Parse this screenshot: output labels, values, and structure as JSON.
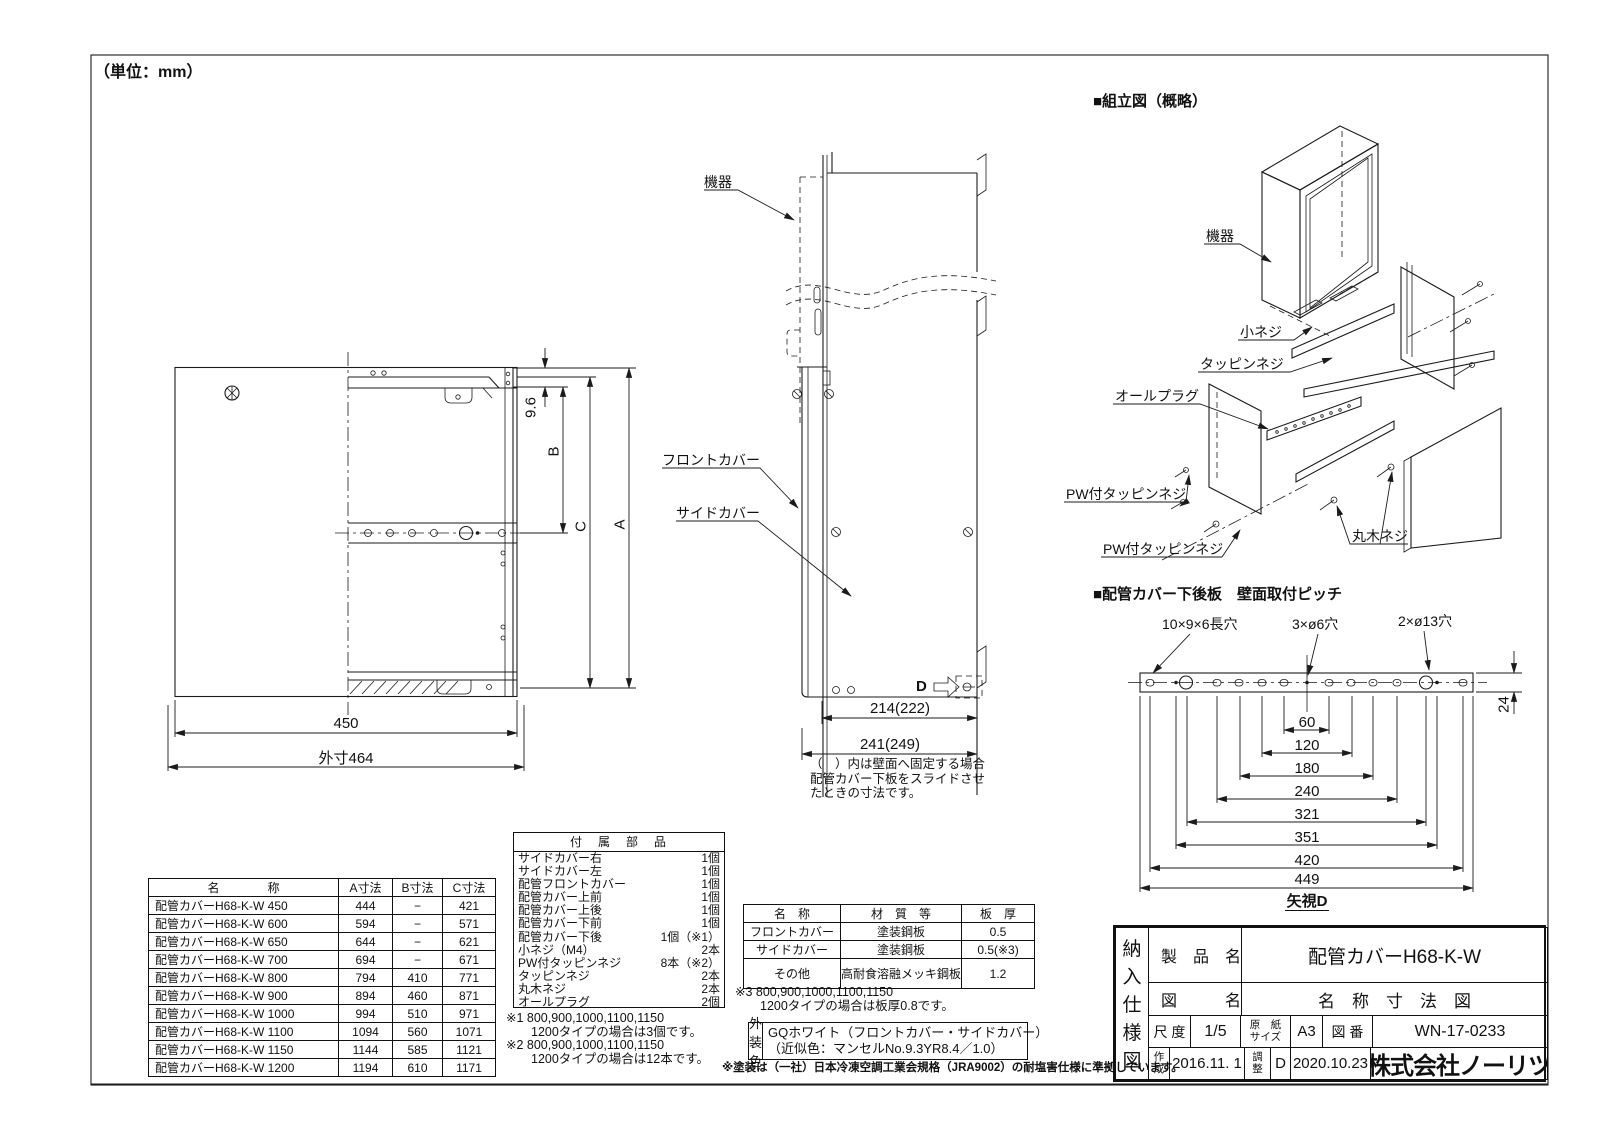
{
  "meta": {
    "unit_note": "（単位：mm）"
  },
  "front_view": {
    "dim_450": "450",
    "dim_464": "外寸464",
    "dim_96": "9.6",
    "dim_B": "B",
    "dim_C": "C",
    "dim_A": "A"
  },
  "side_view": {
    "label_equipment": "機器",
    "label_front_cover": "フロントカバー",
    "label_side_cover": "サイドカバー",
    "dim_214": "214(222)",
    "dim_241": "241(249)",
    "arrow_d": "D",
    "note_lines": [
      "（　）内は壁面へ固定する場合",
      "配管カバー下板をスライドさせ",
      "たときの寸法です。"
    ]
  },
  "assembly": {
    "title": "■組立図（概略）",
    "label_equipment": "機器",
    "label_small_screw": "小ネジ",
    "label_tapping": "タッピンネジ",
    "label_all_plug": "オールプラグ",
    "label_pw_tapping_1": "PW付タッピンネジ",
    "label_pw_tapping_2": "PW付タッピンネジ",
    "label_round_wood_screw": "丸木ネジ"
  },
  "pitch_view": {
    "title": "■配管カバー下後板　壁面取付ピッチ",
    "hole_label_slot": "10×9×6長穴",
    "hole_label_d6": "3×ø6穴",
    "hole_label_d13": "2×ø13穴",
    "dims": [
      "60",
      "120",
      "180",
      "240",
      "321",
      "351",
      "420",
      "449"
    ],
    "dim_24": "24",
    "view_label": "矢視D"
  },
  "dimension_table": {
    "headers": [
      "名　　　　称",
      "A寸法",
      "B寸法",
      "C寸法"
    ],
    "rows": [
      [
        "配管カバーH68-K-W 450",
        "444",
        "−",
        "421"
      ],
      [
        "配管カバーH68-K-W 600",
        "594",
        "−",
        "571"
      ],
      [
        "配管カバーH68-K-W 650",
        "644",
        "−",
        "621"
      ],
      [
        "配管カバーH68-K-W 700",
        "694",
        "−",
        "671"
      ],
      [
        "配管カバーH68-K-W 800",
        "794",
        "410",
        "771"
      ],
      [
        "配管カバーH68-K-W 900",
        "894",
        "460",
        "871"
      ],
      [
        "配管カバーH68-K-W 1000",
        "994",
        "510",
        "971"
      ],
      [
        "配管カバーH68-K-W 1100",
        "1094",
        "560",
        "1071"
      ],
      [
        "配管カバーH68-K-W 1150",
        "1144",
        "585",
        "1121"
      ],
      [
        "配管カバーH68-K-W 1200",
        "1194",
        "610",
        "1171"
      ]
    ]
  },
  "parts_table": {
    "title": "付　属　部　品",
    "items": [
      {
        "name": "サイドカバー右",
        "qty": "1個"
      },
      {
        "name": "サイドカバー左",
        "qty": "1個"
      },
      {
        "name": "配管フロントカバー",
        "qty": "1個"
      },
      {
        "name": "配管カバー上前",
        "qty": "1個"
      },
      {
        "name": "配管カバー上後",
        "qty": "1個"
      },
      {
        "name": "配管カバー下前",
        "qty": "1個"
      },
      {
        "name": "配管カバー下後",
        "qty": "1個（※1）"
      },
      {
        "name": "小ネジ（M4）",
        "qty": "2本"
      },
      {
        "name": "PW付タッピンネジ",
        "qty": "8本（※2）"
      },
      {
        "name": "タッピンネジ",
        "qty": "2本"
      },
      {
        "name": "丸木ネジ",
        "qty": "2本"
      },
      {
        "name": "オールプラグ",
        "qty": "2個"
      }
    ],
    "notes": [
      "※1 800,900,1000,1100,1150",
      "　　1200タイプの場合は3個です。",
      "※2 800,900,1000,1100,1150",
      "　　1200タイプの場合は12本です。"
    ]
  },
  "material_table": {
    "headers": [
      "名　称",
      "材　質　等",
      "板　厚"
    ],
    "rows": [
      [
        "フロントカバー",
        "塗装鋼板",
        "0.5"
      ],
      [
        "サイドカバー",
        "塗装鋼板",
        "0.5(※3)"
      ],
      [
        "その他",
        "高耐食溶融メッキ鋼板",
        "1.2"
      ]
    ],
    "note_lines": [
      "※3 800,900,1000,1100,1150",
      "　　1200タイプの場合は板厚0.8です。"
    ]
  },
  "color_box": {
    "label": "外装色",
    "line1": "GQホワイト（フロントカバー・サイドカバー）",
    "line2": "（近似色：マンセルNo.9.3YR8.4／1.0）"
  },
  "paint_note": "※塗装は（一社）日本冷凍空調工業会規格（JRA9002）の耐塩害仕様に準拠しています。",
  "title_block": {
    "doc_chars": [
      "納",
      "入",
      "仕",
      "様",
      "図"
    ],
    "product_label": "製　品　名",
    "product_value": "配管カバーH68-K-W",
    "drawing_label": "図　　　名",
    "drawing_value": "名　称　寸　法　図",
    "scale_label": "尺 度",
    "scale_value": "1/5",
    "paper_label_1": "原　紙",
    "paper_label_2": "サイズ",
    "paper_value": "A3",
    "number_label": "図 番",
    "number_value": "WN-17-0233",
    "created_label_1": "作",
    "created_label_2": "成",
    "created_value": "2016.11. 1",
    "adjusted_label_1": "調",
    "adjusted_label_2": "整",
    "adjusted_mark": "D",
    "adjusted_value": "2020.10.23",
    "company": "株式会社ノーリツ"
  }
}
